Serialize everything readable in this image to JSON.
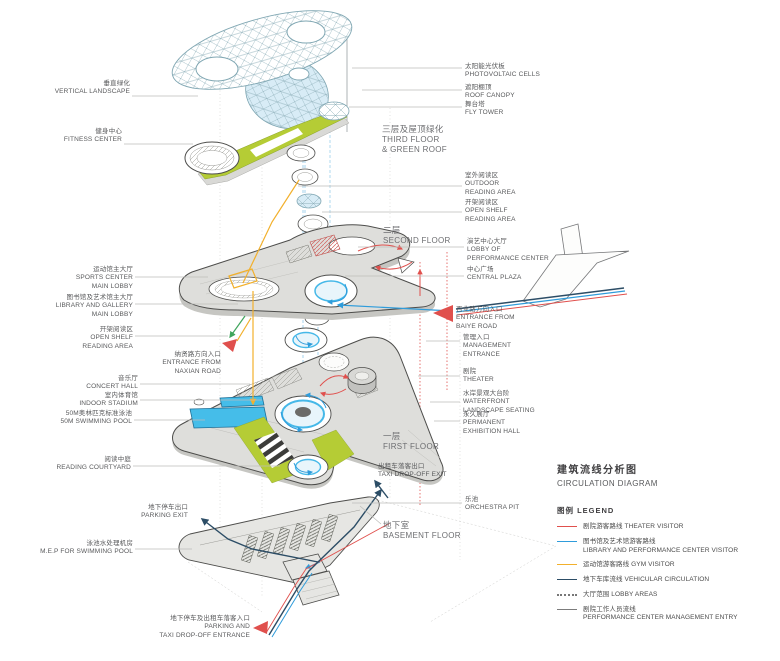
{
  "title": {
    "zh": "建筑流线分析图",
    "en": "CIRCULATION DIAGRAM"
  },
  "floors": {
    "third": {
      "zh": "三层及屋顶绿化",
      "en": "THIRD FLOOR\n& GREEN ROOF"
    },
    "second": {
      "zh": "二层",
      "en": "SECOND FLOOR"
    },
    "first": {
      "zh": "一层",
      "en": "FIRST FLOOR"
    },
    "basement": {
      "zh": "地下室",
      "en": "BASEMENT FLOOR"
    }
  },
  "labels": {
    "vertical_landscape": {
      "zh": "垂直绿化",
      "en": "VERTICAL LANDSCAPE"
    },
    "fitness_center": {
      "zh": "健身中心",
      "en": "FITNESS CENTER"
    },
    "sports_lobby": {
      "zh": "运动馆主大厅",
      "en": "SPORTS CENTER\nMAIN LOBBY"
    },
    "library_gallery_lobby": {
      "zh": "图书馆及艺术馆主大厅",
      "en": "LIBRARY AND GALLERY\nMAIN LOBBY"
    },
    "open_shelf_left": {
      "zh": "开架阅读区",
      "en": "OPEN SHELF\nREADING AREA"
    },
    "concert_hall": {
      "zh": "音乐厅",
      "en": "CONCERT HALL"
    },
    "indoor_stadium": {
      "zh": "室内体育馆",
      "en": "INDOOR STADIUM"
    },
    "swimming_pool": {
      "zh": "50M奥林匹克标准泳池",
      "en": "50M SWIMMING POOL"
    },
    "reading_courtyard": {
      "zh": "阅读中庭",
      "en": "READING COURTYARD"
    },
    "parking_exit": {
      "zh": "地下停车出口",
      "en": "PARKING EXIT"
    },
    "mep_pool": {
      "zh": "泳池水处理机房",
      "en": "M.E.P FOR SWIMMING POOL"
    },
    "parking_entrance": {
      "zh": "地下停车及出租车落客入口",
      "en": "PARKING AND\nTAXI DROP-OFF ENTRANCE"
    },
    "naxian_entrance": {
      "zh": "纳贤路方向入口",
      "en": "ENTRANCE FROM\nNAXIAN ROAD"
    },
    "pv_cells": {
      "zh": "太阳能光伏板",
      "en": "PHOTOVOLTAIC CELLS"
    },
    "roof_canopy": {
      "zh": "遮阳棚顶",
      "en": "ROOF CANOPY"
    },
    "fly_tower": {
      "zh": "舞台塔",
      "en": "FLY TOWER"
    },
    "outdoor_reading": {
      "zh": "室外阅读区",
      "en": "OUTDOOR\nREADING AREA"
    },
    "open_shelf_right": {
      "zh": "开架阅读区",
      "en": "OPEN SHELF\nREADING AREA"
    },
    "perf_lobby": {
      "zh": "演艺中心大厅",
      "en": "LOBBY OF\nPERFORMANCE CENTER"
    },
    "central_plaza": {
      "zh": "中心广场",
      "en": "CENTRAL PLAZA"
    },
    "baiye_entrance": {
      "zh": "百业路方向入口",
      "en": "ENTRANCE FROM\nBAIYE ROAD"
    },
    "management_entrance": {
      "zh": "管理入口",
      "en": "MANAGEMENT\nENTRANCE"
    },
    "theater": {
      "zh": "剧院",
      "en": "THEATER"
    },
    "waterfront_seating": {
      "zh": "水岸景观大台阶",
      "en": "WATERFRONT\nLANDSCAPE SEATING"
    },
    "permanent_hall": {
      "zh": "永久展厅",
      "en": "PERMANENT\nEXHIBITION HALL"
    },
    "taxi_exit": {
      "zh": "出租车落客出口",
      "en": "TAXI DROP-OFF EXIT"
    },
    "orchestra_pit": {
      "zh": "乐池",
      "en": "ORCHESTRA PIT"
    }
  },
  "legend": {
    "title": "图例  LEGEND",
    "items": [
      {
        "label": "剧院游客路线 THEATER VISITOR",
        "color": "#e0504d",
        "style": "solid"
      },
      {
        "label": "图书馆及艺术馆游客路线\nLIBRARY AND PERFORMANCE CENTER VISITOR",
        "color": "#2f9cdb",
        "style": "solid"
      },
      {
        "label": "运动馆游客路线 GYM VISITOR",
        "color": "#f2b02c",
        "style": "solid"
      },
      {
        "label": "地下车库流线 VEHICULAR CIRCULATION",
        "color": "#2c4d66",
        "style": "solid"
      },
      {
        "label": "大厅范围 LOBBY AREAS",
        "color": "#777777",
        "style": "dotted"
      },
      {
        "label": "剧院工作人员流线\nPERFORMANCE CENTER MANAGEMENT ENTRY",
        "color": "#7c7c7c",
        "style": "solid"
      }
    ]
  },
  "colors": {
    "theater_route": "#e0504d",
    "library_route": "#2f9cdb",
    "gym_route": "#f2b02c",
    "vehicular_route": "#2c4d66",
    "green_roof": "#b5cc35",
    "pool_cyan": "#45bde9",
    "plate_gray": "#dededb",
    "canopy_blue": "#d8ecf6"
  }
}
